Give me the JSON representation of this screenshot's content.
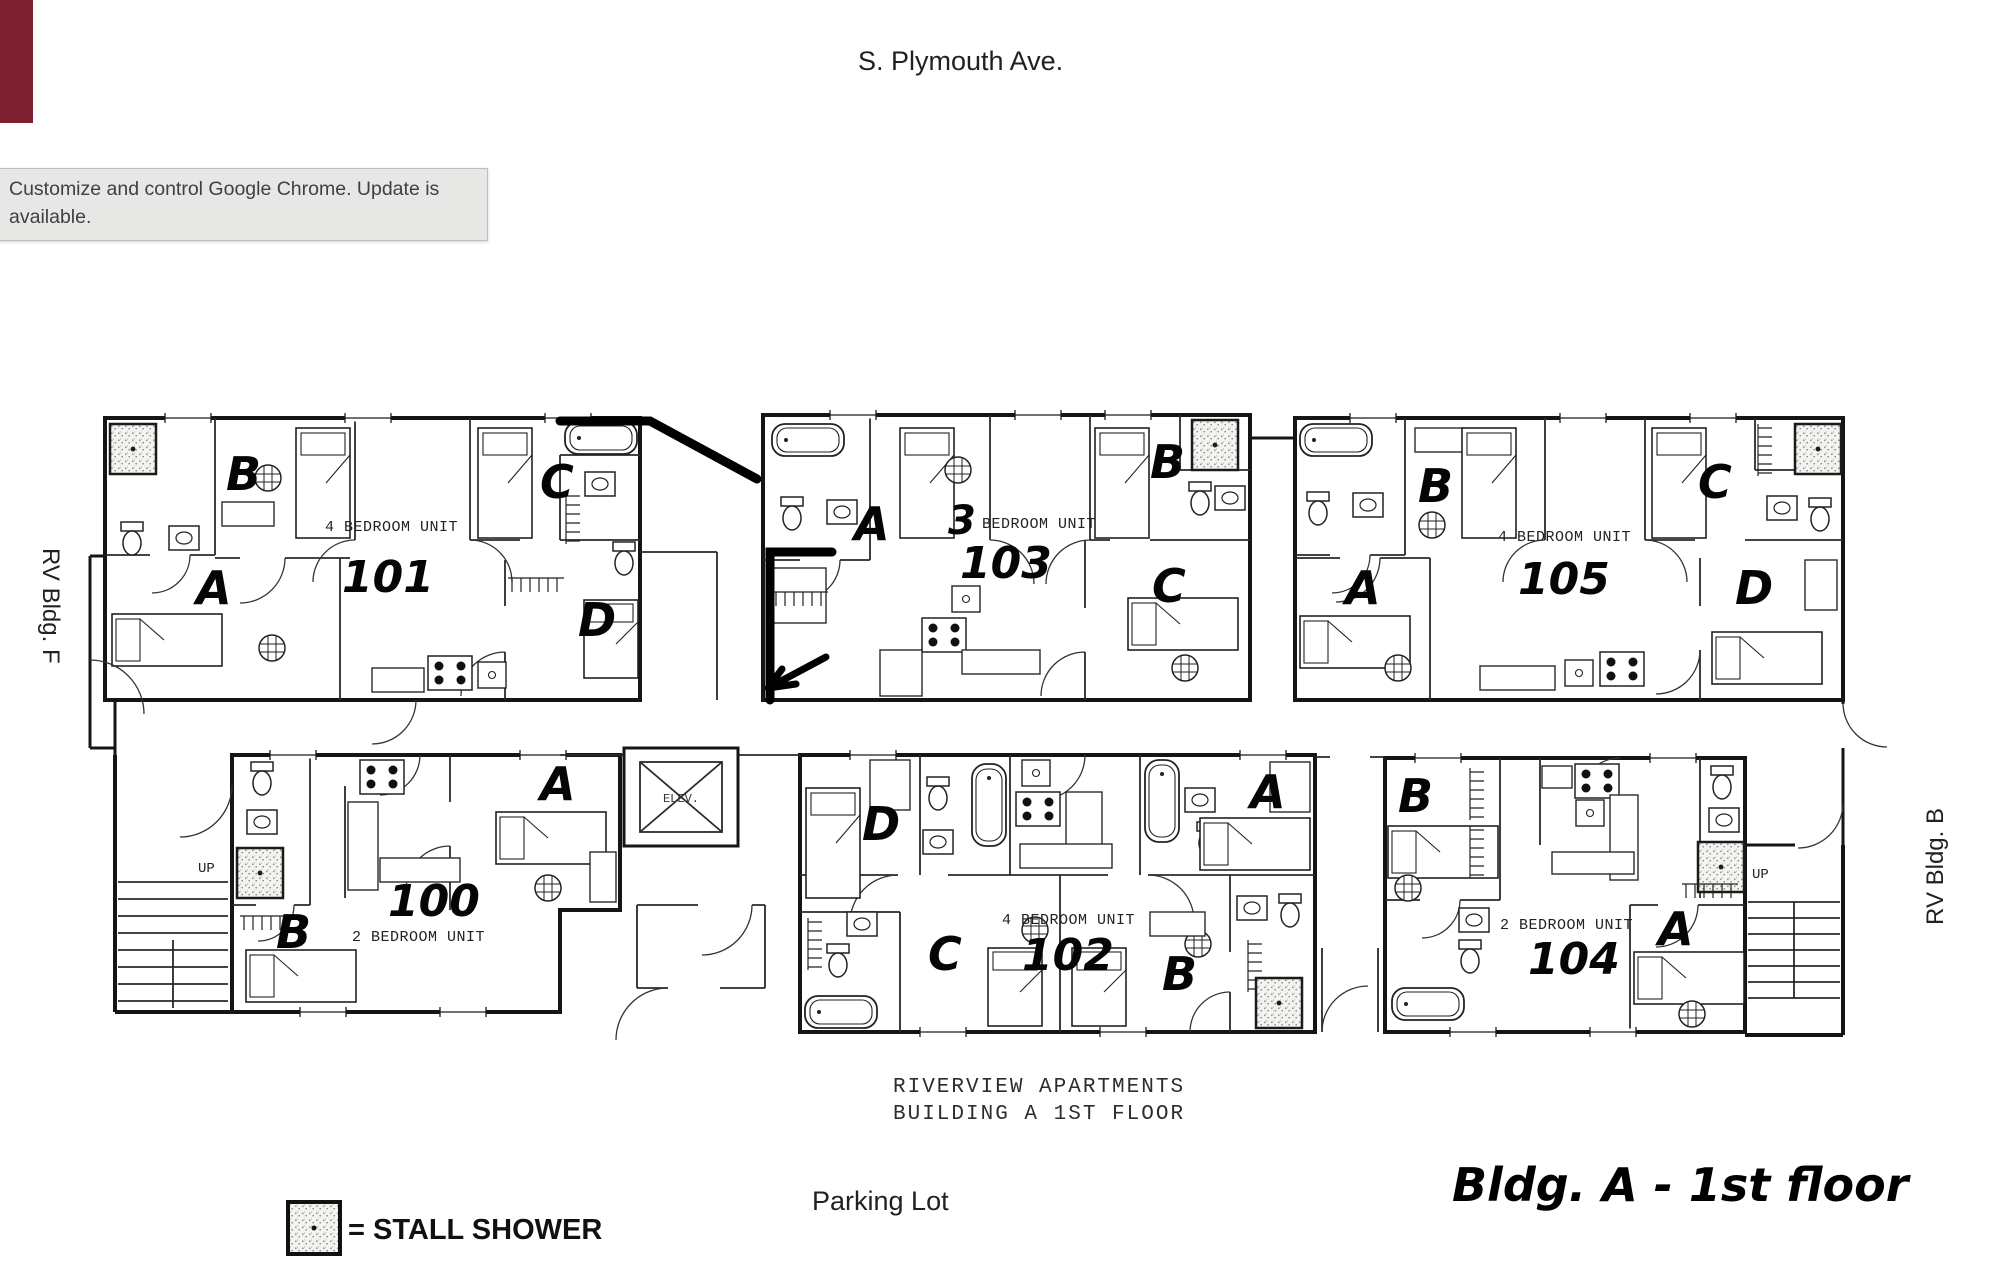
{
  "street": {
    "label": "S. Plymouth Ave."
  },
  "chrome_tooltip": {
    "text": "Customize and control Google Chrome. Update is available."
  },
  "side_labels": {
    "left": "RV Bldg. F",
    "right": "RV Bldg. B"
  },
  "plan": {
    "title_line1": "RIVERVIEW APARTMENTS",
    "title_line2": "BUILDING A 1ST FLOOR",
    "elevator_label": "ELEV.",
    "stairs": {
      "left_up": "UP",
      "right_up": "UP"
    },
    "units": [
      {
        "number": "101",
        "type": "4 BEDROOM UNIT",
        "rooms": [
          "A",
          "B",
          "C",
          "D"
        ]
      },
      {
        "number": "103",
        "type_prefix": "3",
        "type": "BEDROOM UNIT",
        "rooms": [
          "A",
          "B",
          "C"
        ]
      },
      {
        "number": "105",
        "type": "4 BEDROOM UNIT",
        "rooms": [
          "A",
          "B",
          "C",
          "D"
        ]
      },
      {
        "number": "100",
        "type": "2 BEDROOM UNIT",
        "rooms": [
          "A",
          "B"
        ]
      },
      {
        "number": "102",
        "type": "4 BEDROOM UNIT",
        "rooms": [
          "A",
          "B",
          "C",
          "D"
        ]
      },
      {
        "number": "104",
        "type": "2 BEDROOM UNIT",
        "rooms": [
          "A",
          "B"
        ]
      }
    ]
  },
  "legend": {
    "label": "= STALL SHOWER"
  },
  "parking": {
    "label": "Parking Lot"
  },
  "note": {
    "text": "Bldg. A - 1st floor"
  }
}
